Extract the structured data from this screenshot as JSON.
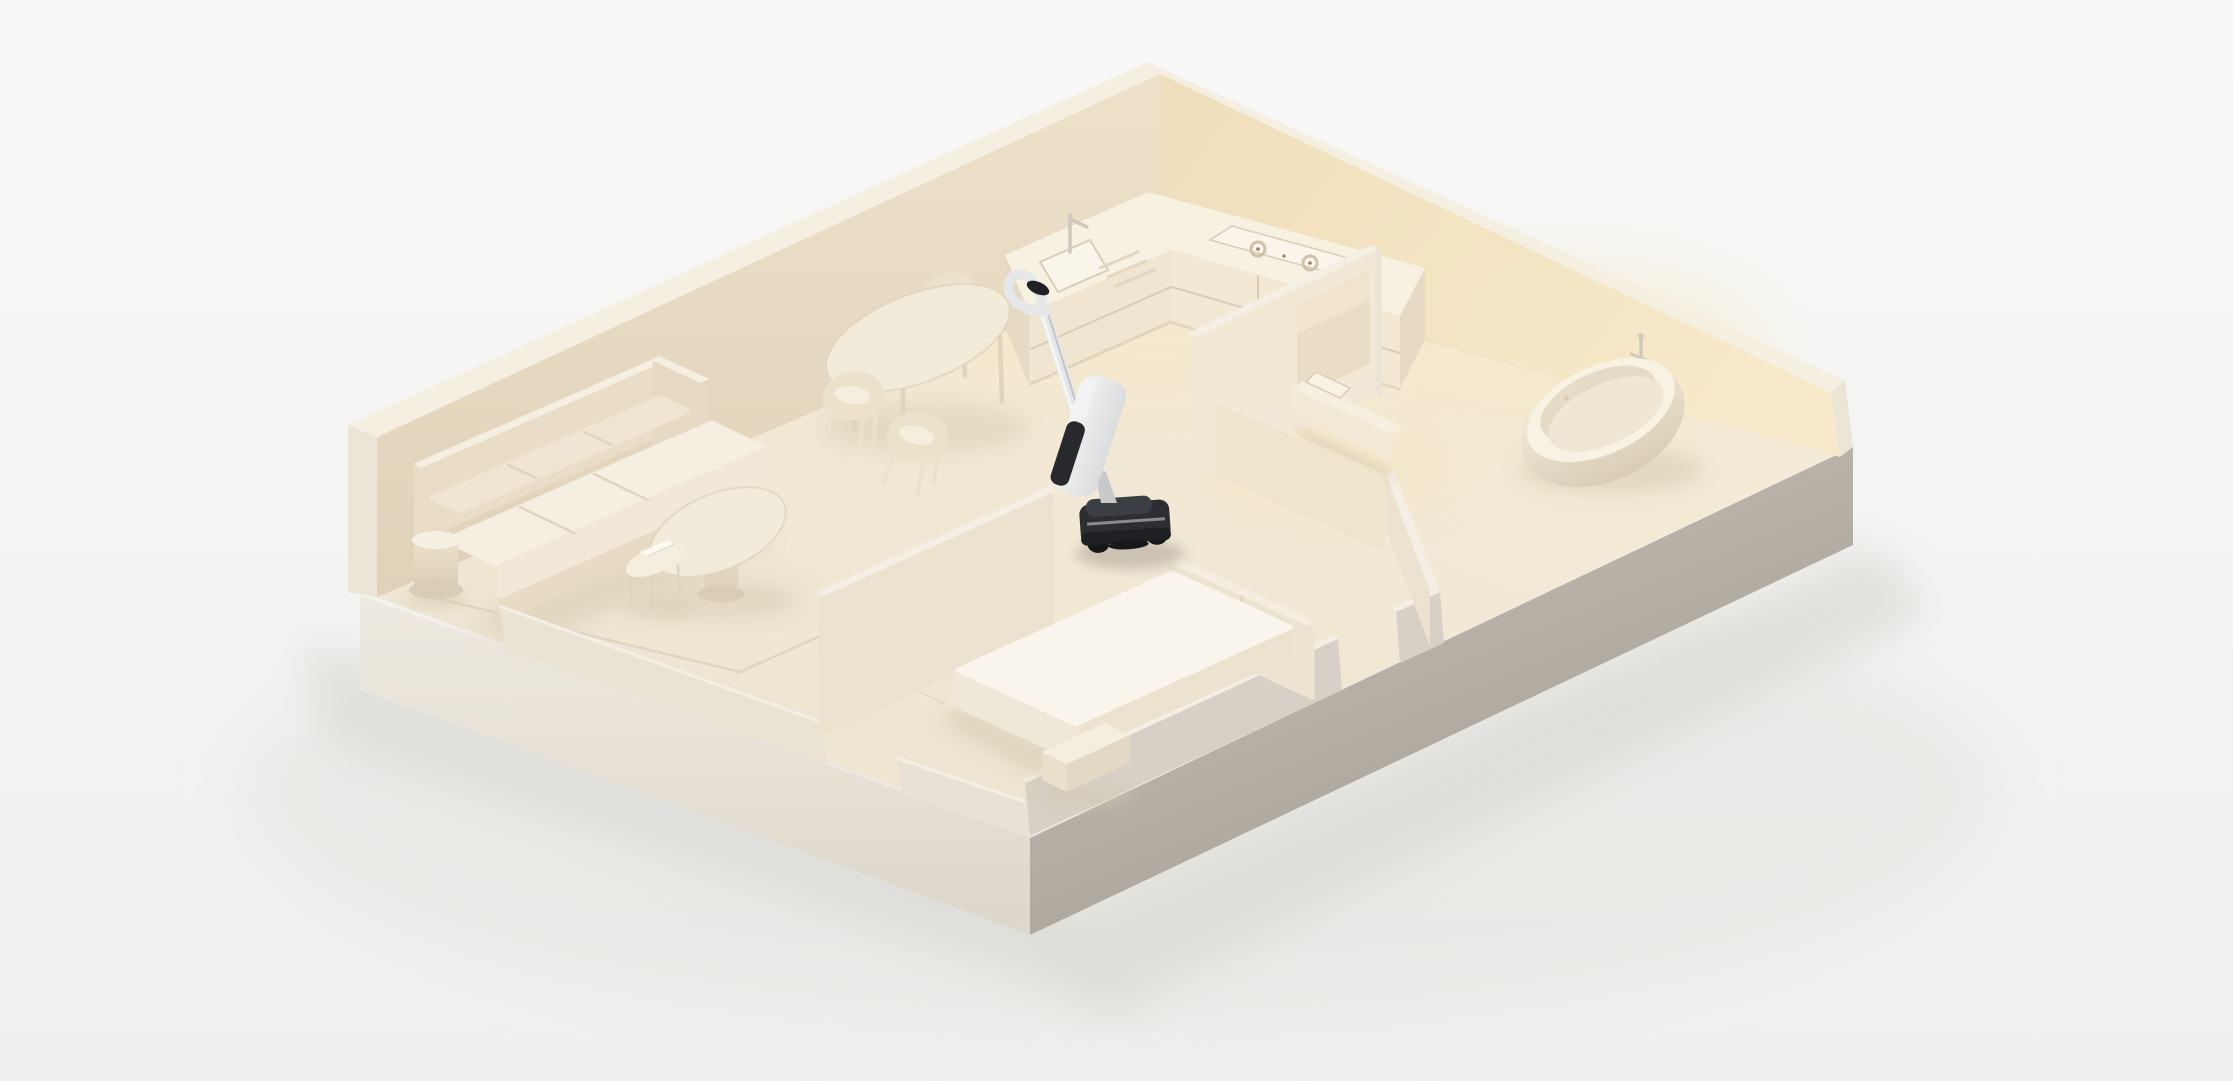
{
  "app": {
    "title": "Isometric apartment diorama with cordless stick vacuum"
  },
  "palette": {
    "bg1": "#f8f8f7",
    "bg2": "#efefed",
    "groundShadow": "#dcdad6",
    "groundShadow2": "#e6e5e2",
    "floorWarm": "#f6edd9",
    "floorBase": "#ece3d0",
    "glowWarm": "#f7e7c2",
    "aoLine": "#cdbfa4",
    "aoLineWarm": "#d8c8a8",
    "rugLine": "#d9cfbc",
    "wallCap": "#f5efe2",
    "wallOuter": "#f3f0ea",
    "wallEnd": "#ebe5d8",
    "wallInnerTLTop": "#eee1ca",
    "wallInnerTLBot": "#e0d2b9",
    "wallInnerTR1": "#efdebb",
    "wallInnerTR2": "#f7e9c9",
    "slabBL1": "#efeae1",
    "slabBL2": "#ddd6ca",
    "slabBR1": "#cdc7be",
    "slabBR2": "#a09a90",
    "partition": "#ece2d0",
    "partitionLit": "#f2e8d6",
    "partitionFace": "#efe4cd",
    "parapetFace": "#eae3d4",
    "rimWallOuter": "#d6d0c6",
    "rimWallCap": "#f4efe4",
    "rimWallInner": "#e8e2d6",
    "counterFront": "#efe5d0",
    "counterFrontLit": "#f2e8d3",
    "counterTop": "#f7f1e2",
    "counterSide": "#e6dac4",
    "seam": "#d9cdb8",
    "cooktop": "#faf5ea",
    "burner": "#cfc2a8",
    "burnerDot": "#8a8274",
    "rack": "#e3d7c0",
    "faucet": "#cfc9bb",
    "sofaBase": "#e7dbc5",
    "sofaBack": "#e9ddc7",
    "sofaArm": "#e6dac4",
    "cushionTop": "#f5efe2",
    "cushionFront": "#f1e8d7",
    "backCushion": "#efe5d2",
    "cushionSeam": "#dfd4bf",
    "tableTop": "#f3ebda",
    "tableLeg": "#e0d4bd",
    "tableRim": "#ddd1ba",
    "pedestal1": "#ece1cb",
    "pedestal2": "#d9cdb6",
    "chairShell": "#ece1cb",
    "chairInner": "#f5eddd",
    "book": "#fbf9f2",
    "bookEdge": "#e5dbc6",
    "tub1": "#f4ecdc",
    "tub2": "#d9cdb6",
    "tubRim": "#f8f2e3",
    "tubInner": "#efe7d4",
    "tubShade": "#d8cbb2",
    "mirror": "#e9ddc6",
    "mirrorSheen": "#f2e7d1",
    "vanityTop": "#f6efe0",
    "vanityFront": "#f2e9d7",
    "basin": "#f8f2e4",
    "slotShadow": "#b9a98c",
    "bedTop": "#f9f5ec",
    "bedSide": "#efe7d7",
    "bedSideDark": "#ece2cf",
    "platform": "#eee5d2",
    "headboard": "#ece3d0",
    "headboardCap": "#f5eedf",
    "bench": "#f4eedf",
    "benchSide": "#e9e0cc",
    "benchSideDark": "#e2d8c3",
    "furnShadow": "#d3c7ae",
    "furnShadowSoft": "#d5c9b0",
    "vacBody1": "#f3f4f5",
    "vacBody2": "#dadcde",
    "vacStick": "#e5e7e9",
    "vacStickHi": "#f4f5f6",
    "vacStickLo": "#c2c4c6",
    "vacDark": "#2c2e31",
    "vacDarker": "#1e2023",
    "vacBaseTop": "#3b3e42",
    "vacWheel": "#17181a",
    "vacSilver": "#c7c9cb",
    "vacTank": "#27292c",
    "vacCap": "#1f2124",
    "vacShadow": "#aaa294"
  },
  "scene": {
    "type": "3d-isometric-apartment-model",
    "lighting": "soft warm studio light from upper right",
    "rooms": [
      {
        "name": "kitchen",
        "position": "top corner",
        "items": [
          "l-shaped-counter",
          "sink",
          "faucet",
          "dish-rack",
          "gas-cooktop",
          "oven-drawer"
        ]
      },
      {
        "name": "living-room",
        "position": "left corner",
        "items": [
          "three-seat-sofa",
          "round-side-table",
          "nesting-coffee-tables",
          "book",
          "rug-outline"
        ]
      },
      {
        "name": "dining-area",
        "position": "center-left",
        "items": [
          "oval-dining-table",
          "dining-chairs-x3"
        ]
      },
      {
        "name": "vanity-niche",
        "position": "center-right",
        "items": [
          "wall-mirror",
          "floating-vanity",
          "washbasin"
        ]
      },
      {
        "name": "bathroom",
        "position": "right corner",
        "items": [
          "freestanding-bathtub",
          "floor-mounted-faucet"
        ]
      },
      {
        "name": "bedroom",
        "position": "bottom corner",
        "items": [
          "platform-bed",
          "headboard-panels",
          "foot-bench"
        ]
      }
    ],
    "device": {
      "name": "cordless-wet-dry-stick-vacuum",
      "location": "central hallway, tilted upright",
      "parts": [
        "loop-handle",
        "dark-handle-cap",
        "telescopic-stick",
        "white-body",
        "dark-water-tank",
        "dark-floor-head",
        "wheels"
      ]
    }
  }
}
